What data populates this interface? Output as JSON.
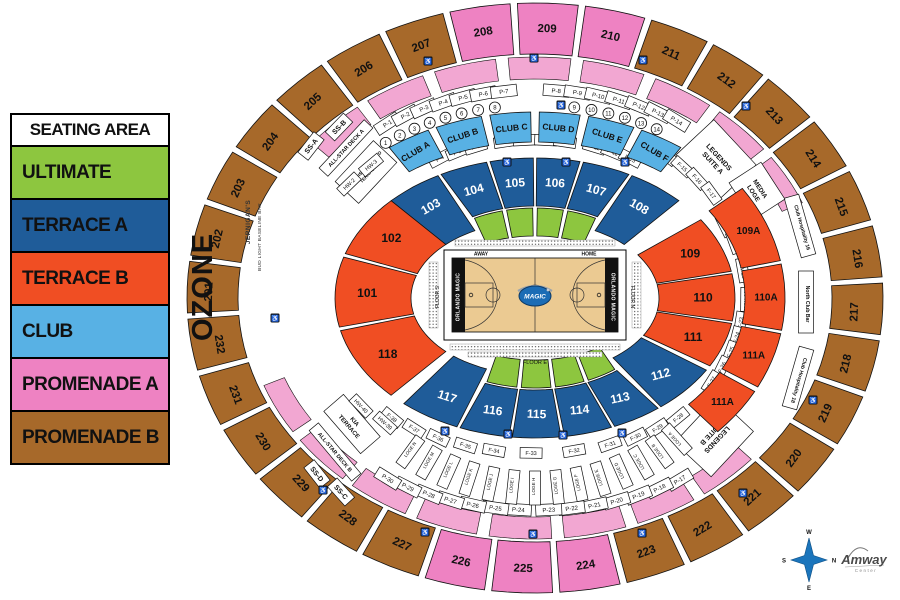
{
  "legend": {
    "title": "SEATING AREA",
    "items": [
      {
        "label": "ULTIMATE",
        "category": "ultimate"
      },
      {
        "label": "TERRACE A",
        "category": "terrace_a"
      },
      {
        "label": "TERRACE B",
        "category": "terrace_b"
      },
      {
        "label": "CLUB",
        "category": "club"
      },
      {
        "label": "PROMENADE A",
        "category": "promenade_a"
      },
      {
        "label": "PROMENADE B",
        "category": "promenade_b"
      }
    ]
  },
  "ozone_label": "OZONE",
  "colors": {
    "ultimate": "#8DC63F",
    "terrace_a": "#1F5C99",
    "terrace_b": "#F04E23",
    "club": "#58B1E4",
    "promenade_a": "#EE82C2",
    "promenade_a_light": "#F2A7D2",
    "promenade_b": "#A7692A",
    "court_floor": "#EBCA92",
    "logo_blue": "#1B6CB5",
    "compass_blue": "#1B75BC"
  },
  "arena": {
    "outer_ring": [
      {
        "label": "207",
        "category": "promenade_b"
      },
      {
        "label": "208",
        "category": "promenade_a"
      },
      {
        "label": "209",
        "category": "promenade_a"
      },
      {
        "label": "210",
        "category": "promenade_a"
      },
      {
        "label": "211",
        "category": "promenade_b"
      },
      {
        "label": "212",
        "category": "promenade_b"
      },
      {
        "label": "213",
        "category": "promenade_b"
      },
      {
        "label": "214",
        "category": "promenade_b"
      },
      {
        "label": "215",
        "category": "promenade_b"
      },
      {
        "label": "216",
        "category": "promenade_b"
      },
      {
        "label": "217",
        "category": "promenade_b"
      },
      {
        "label": "218",
        "category": "promenade_b"
      },
      {
        "label": "219",
        "category": "promenade_b"
      },
      {
        "label": "220",
        "category": "promenade_b"
      },
      {
        "label": "221",
        "category": "promenade_b"
      },
      {
        "label": "222",
        "category": "promenade_b"
      },
      {
        "label": "223",
        "category": "promenade_b"
      },
      {
        "label": "224",
        "category": "promenade_a"
      },
      {
        "label": "225",
        "category": "promenade_a"
      },
      {
        "label": "226",
        "category": "promenade_a"
      },
      {
        "label": "227",
        "category": "promenade_b"
      },
      {
        "label": "228",
        "category": "promenade_b"
      },
      {
        "label": "229",
        "category": "promenade_b"
      },
      {
        "label": "230",
        "category": "promenade_b"
      },
      {
        "label": "231",
        "category": "promenade_b"
      },
      {
        "label": "232",
        "category": "promenade_b"
      },
      {
        "label": "201",
        "category": "promenade_b"
      },
      {
        "label": "202",
        "category": "promenade_b"
      },
      {
        "label": "203",
        "category": "promenade_b"
      },
      {
        "label": "204",
        "category": "promenade_b"
      },
      {
        "label": "205",
        "category": "promenade_b"
      },
      {
        "label": "206",
        "category": "promenade_b"
      }
    ],
    "inner_bowl": [
      {
        "label": "103",
        "category": "terrace_a"
      },
      {
        "label": "104",
        "category": "terrace_a",
        "ultimate_rows": true
      },
      {
        "label": "105",
        "category": "terrace_a",
        "ultimate_rows": true
      },
      {
        "label": "106",
        "category": "terrace_a",
        "ultimate_rows": true
      },
      {
        "label": "107",
        "category": "terrace_a",
        "ultimate_rows": true
      },
      {
        "label": "108",
        "category": "terrace_a"
      },
      {
        "label": "109",
        "category": "terrace_b"
      },
      {
        "label": "110",
        "category": "terrace_b"
      },
      {
        "label": "111",
        "category": "terrace_b"
      },
      {
        "label": "112",
        "category": "terrace_a"
      },
      {
        "label": "113",
        "category": "terrace_a",
        "ultimate_rows": true
      },
      {
        "label": "114",
        "category": "terrace_a",
        "ultimate_rows": true
      },
      {
        "label": "115",
        "category": "terrace_a",
        "ultimate_rows": true
      },
      {
        "label": "116",
        "category": "terrace_a",
        "ultimate_rows": true
      },
      {
        "label": "117",
        "category": "terrace_a"
      },
      {
        "label": "118",
        "category": "terrace_b"
      },
      {
        "label": "101",
        "category": "terrace_b"
      },
      {
        "label": "102",
        "category": "terrace_b"
      }
    ],
    "inner_ring_a": [
      {
        "label": "109A",
        "category": "terrace_b"
      },
      {
        "label": "110A",
        "category": "terrace_b"
      },
      {
        "label": "111A",
        "category": "terrace_b"
      },
      {
        "label": "111A",
        "category": "terrace_b"
      }
    ],
    "club_boxes": [
      "CLUB A",
      "CLUB B",
      "CLUB C",
      "CLUB D",
      "CLUB E",
      "CLUB F"
    ],
    "p_labels_top": [
      "P-1",
      "P-2",
      "P-3",
      "P-4",
      "P-5",
      "P-6",
      "P-7",
      "P-8",
      "P-9",
      "P-10",
      "P-11",
      "P-12",
      "P-13",
      "P-14"
    ],
    "p_labels_bottom": [
      "P-17",
      "P-18",
      "P-19",
      "P-20",
      "P-21",
      "P-22",
      "P-23",
      "P-24",
      "P-25",
      "P-26",
      "P-27",
      "P-28",
      "P-29",
      "P-30"
    ],
    "f_labels_top": [
      "F-4",
      "F-5",
      "F-6",
      "F-7",
      "F-8",
      "F-9",
      "F-10",
      "F-11",
      "F-12",
      "F-13",
      "F-14",
      "F-15",
      "F-16",
      "F-17"
    ],
    "f_labels_right": [
      "F-18",
      "F-19"
    ],
    "hw_labels_right": [
      "HW-20",
      "HW-22"
    ],
    "f_labels_right_lower": [
      "F-23",
      "F-24",
      "F-25",
      "F-26",
      "F-27"
    ],
    "f_labels_bottom": [
      "F-28",
      "F-29",
      "F-30",
      "F-31",
      "F-32",
      "F-33",
      "F-34",
      "F-35",
      "F-36",
      "F-37",
      "F-38"
    ],
    "hw_labels_top_left": [
      "HW-2",
      "HW-3"
    ],
    "hw_labels_bottom_left": [
      "HW-40",
      "HW-39"
    ],
    "circled_numbers": [
      "1",
      "2",
      "3",
      "4",
      "5",
      "6",
      "7",
      "8",
      "9",
      "10",
      "11",
      "12",
      "13",
      "14"
    ],
    "loge_boxes": [
      "LOGE A",
      "LOGE B",
      "LOGE C",
      "LOGE D",
      "LOGE E",
      "LOGE F",
      "LOGE G",
      "LOGE H",
      "LOGE I",
      "LOGE J",
      "LOGE K",
      "LOGE L",
      "LOGE M",
      "LOGE N"
    ],
    "labels": {
      "legends_suite_a": [
        "LEGENDS",
        "SUITE A"
      ],
      "media_loge": [
        "MEDIA",
        "LOGE"
      ],
      "legends_suite_b": [
        "LEGENDS",
        "SUITE B"
      ],
      "kia_terrace": [
        "KIA",
        "TERRACE"
      ],
      "all_star_deck_a": [
        "ALL-STAR DECK A"
      ],
      "all_star_deck_b": [
        "ALL-STAR DECK B"
      ],
      "walt_disney_world_terrace": [
        "WALT DISNEY WORLD",
        "TERRACE"
      ],
      "ss_a": [
        "SS-A"
      ],
      "ss_b": [
        "SS-B"
      ],
      "ss_c": [
        "SS-C"
      ],
      "ss_d": [
        "SS-D"
      ],
      "jernigans": "JERNIGAN'S",
      "bud_light_baseline_bar": "BUD LIGHT BASELINE BAR",
      "club_hospitality_16": "Club Hospitality 16",
      "north_club_bar": "North Club Bar",
      "club_hospitality_18": "Club Hospitality 18"
    },
    "court": {
      "away": "AWAY",
      "home": "HOME",
      "team_left": "ORLANDO MAGIC",
      "team_right": "ORLANDO MAGIC",
      "logo_text": "MAGIC",
      "floor_s": "FLOOR S",
      "floor_n": "FLOOR N",
      "floor_e": "FLOOR E"
    }
  },
  "compass": {
    "w": "W",
    "n": "N",
    "s": "S",
    "e": "E"
  },
  "branding": {
    "venue_name": "Amway",
    "venue_sub": "Center"
  },
  "icons": {
    "wheelchair": "♿"
  }
}
